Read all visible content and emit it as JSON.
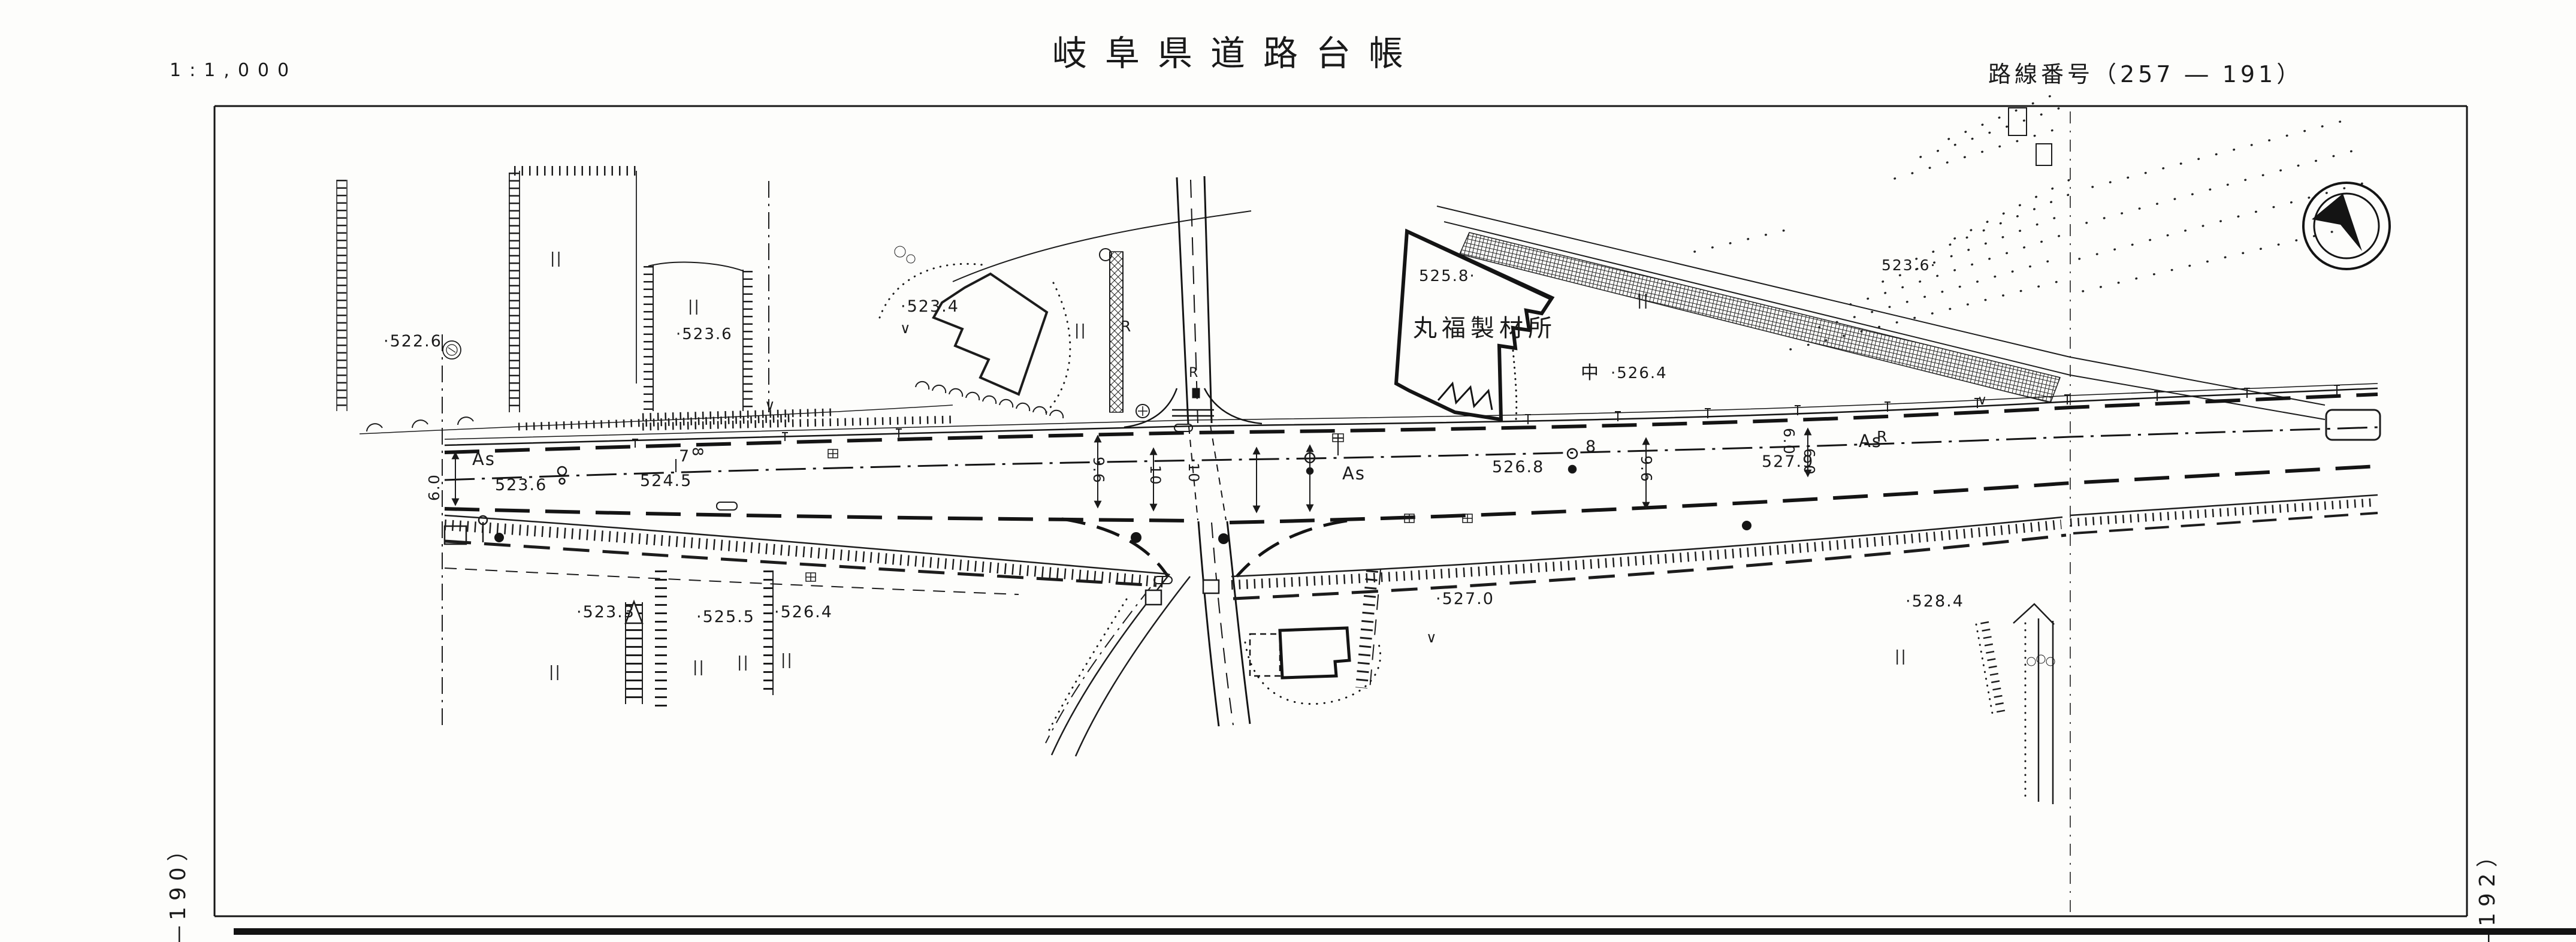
{
  "labels": {
    "scale": "1:1,000",
    "title": "岐阜県道路台帳",
    "route": "路線番号（257 ― 191）",
    "margin_left": "―190）",
    "margin_right": "―192）",
    "elev_522_6": "·522.6",
    "elev_523_6_field": "·523.6",
    "elev_523_4": "·523.4",
    "elev_525_8": "525.8·",
    "elev_526_4_mid": "·526.4",
    "elev_523_6_tr": "523.6·",
    "road_523_6": "523.6",
    "road_524_5": "524.5",
    "road_526_8": "526.8",
    "road_527_9": "527.9",
    "elev_523_3": "·523.3",
    "elev_525_5": "·525.5",
    "elev_526_4_b": "·526.4",
    "elev_527_0": "·527.0",
    "elev_528_4": "·528.4",
    "as1": "As",
    "as2": "As",
    "as3": "As",
    "building_marufuku": "丸福製材所",
    "sym_naka": "中",
    "r1": "R",
    "r2": "R",
    "r3": "R",
    "st7": "7",
    "st8": "8",
    "st8_rot": "8",
    "w60_left": "6.0",
    "w96_a": "9.6",
    "w10_a": "10",
    "w10_b": "10",
    "w96_b": "9.6",
    "w60_r1": "6.0",
    "w60_r2": "6.0",
    "par": "||",
    "check": "∨"
  },
  "colors": {
    "ink": "#1a1a1a",
    "paper": "#fdfdfb"
  },
  "icons": {
    "compass": "north-arrow-icon",
    "stamp": "seal-stamp-icon"
  }
}
